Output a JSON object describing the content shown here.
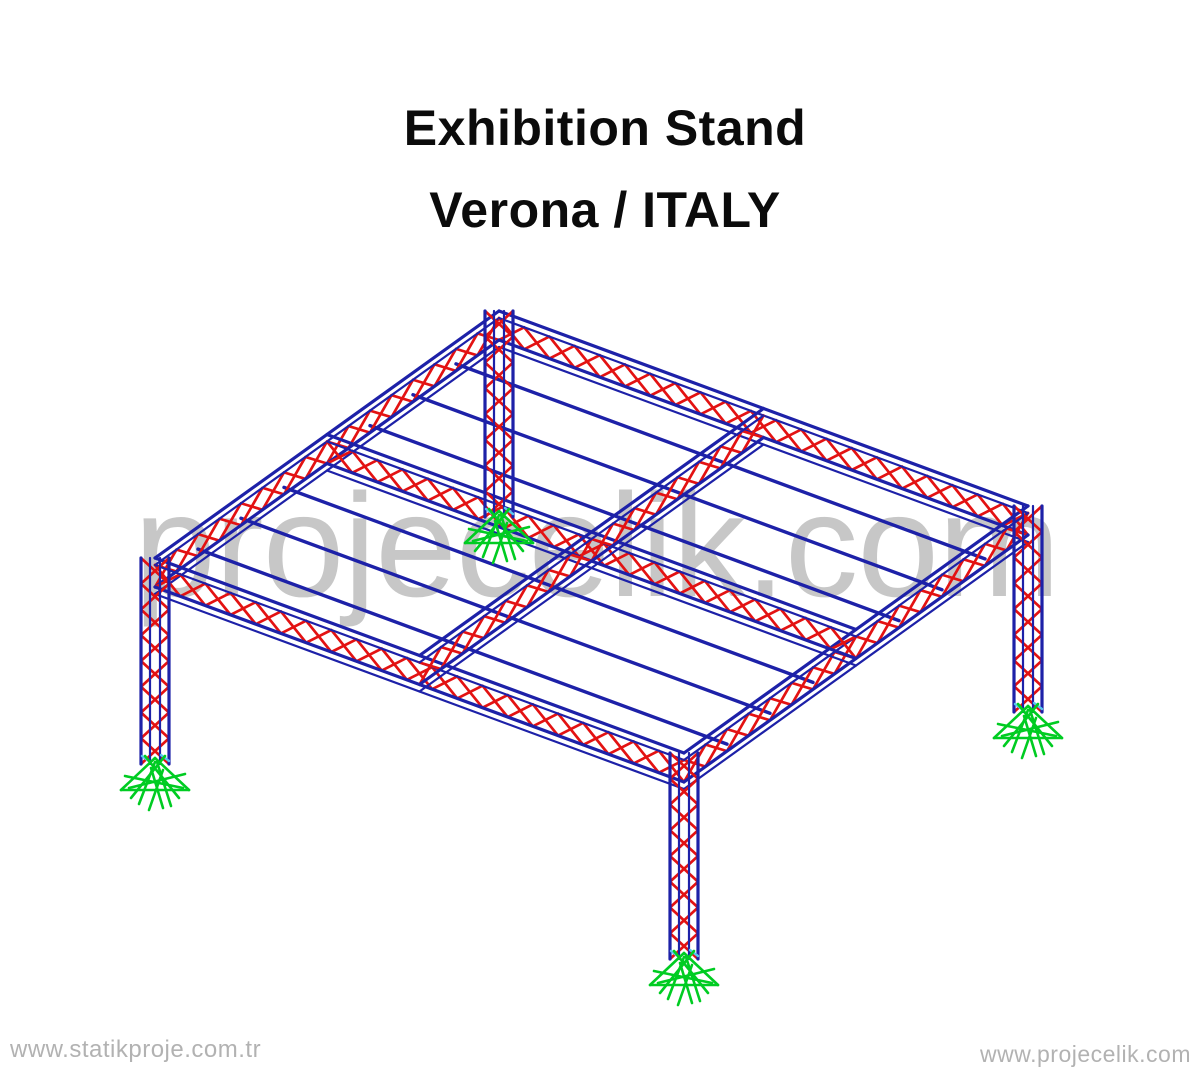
{
  "title": {
    "line1": "Exhibition Stand",
    "line2": "Verona / ITALY"
  },
  "watermark": {
    "text": "projecelik.com"
  },
  "footer": {
    "left_url": "www.statikproje.com.tr",
    "right_url": "www.projecelik.com"
  },
  "colors": {
    "background": "#ffffff",
    "title_text": "#0b0b0b",
    "watermark_text": "#c7c7c7",
    "footer_text": "#b2b2b2",
    "chord_blue": "#1d21a8",
    "web_red": "#e31212",
    "support_green": "#00cc22",
    "node_cyan": "#58c8f0"
  },
  "structure": {
    "kind": "3d-truss-frame-model",
    "origin": [
      499,
      311
    ],
    "axis_u": [
      529,
      195
    ],
    "axis_v": [
      -344,
      247
    ],
    "axis_w": [
      0,
      206
    ],
    "truss_depth": 29,
    "chord_gap": 7,
    "lattice_period": 27,
    "column_half_width": 14,
    "roof_trusses": [
      {
        "name": "roof-truss-back-left-edge",
        "from": [
          0,
          0
        ],
        "to": [
          0,
          1
        ]
      },
      {
        "name": "roof-truss-back-right-edge",
        "from": [
          0,
          0
        ],
        "to": [
          1,
          0
        ]
      },
      {
        "name": "roof-truss-front-left-edge",
        "from": [
          0,
          1
        ],
        "to": [
          1,
          1
        ]
      },
      {
        "name": "roof-truss-front-right-edge",
        "from": [
          1,
          0
        ],
        "to": [
          1,
          1
        ]
      },
      {
        "name": "roof-truss-interior-longitudinal",
        "from": [
          0,
          0.5
        ],
        "to": [
          1,
          0.5
        ]
      },
      {
        "name": "roof-truss-interior-transverse",
        "from": [
          0.5,
          0
        ],
        "to": [
          0.5,
          1
        ]
      }
    ],
    "purlin_v_positions": [
      0.125,
      0.25,
      0.375,
      0.625,
      0.75,
      0.875
    ],
    "columns": [
      {
        "name": "column-back",
        "at": [
          0,
          0
        ]
      },
      {
        "name": "column-left",
        "at": [
          0,
          1
        ]
      },
      {
        "name": "column-right",
        "at": [
          1,
          0
        ]
      },
      {
        "name": "column-front",
        "at": [
          1,
          1
        ]
      }
    ],
    "supports": [
      {
        "name": "support-back",
        "at": [
          0,
          0
        ]
      },
      {
        "name": "support-left",
        "at": [
          0,
          1
        ]
      },
      {
        "name": "support-right",
        "at": [
          1,
          0
        ]
      },
      {
        "name": "support-front",
        "at": [
          1,
          1
        ]
      }
    ]
  }
}
